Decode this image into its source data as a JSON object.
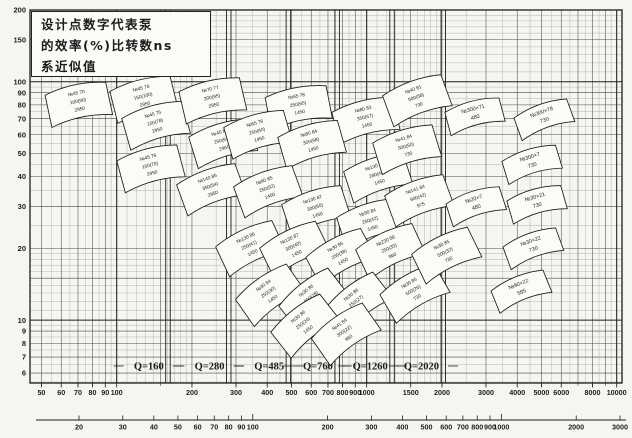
{
  "page": {
    "background": "#f6f5f1",
    "ink": "#1c1c1c",
    "paper": "#fcfbf7"
  },
  "legend": {
    "lines": [
      "设计点数字代表泵",
      "的效率(%)比转数ns",
      "系近似值"
    ]
  },
  "chart_data": {
    "type": "area",
    "subtype": "pump-type-spectrum-log-log-QH-field-chart",
    "title": "",
    "xlabel": "",
    "ylabel": "",
    "x_axis": {
      "scale": "log",
      "min": 45,
      "max": 10500,
      "tick_labels": [
        50,
        60,
        70,
        80,
        90,
        100,
        200,
        300,
        400,
        500,
        600,
        700,
        800,
        900,
        1000,
        1500,
        2000,
        3000,
        4000,
        5000,
        6000,
        8000,
        10000
      ]
    },
    "y_axis": {
      "scale": "log",
      "min": 5.45,
      "max": 200,
      "tick_labels": [
        200,
        150,
        100,
        90,
        80,
        70,
        60,
        50,
        40,
        30,
        20,
        10,
        9,
        8,
        7,
        6
      ]
    },
    "q_dividers": {
      "prefix": "Q=",
      "values": [
        160,
        280,
        485,
        760,
        1260,
        2020
      ],
      "labels": [
        "Q=160",
        "Q=280",
        "Q=485",
        "Q=760",
        "Q=1260",
        "Q=2020"
      ]
    },
    "second_axis": {
      "scale": "log",
      "min": 14,
      "max": 3200,
      "tick_labels": [
        20,
        30,
        40,
        50,
        60,
        70,
        80,
        90,
        100,
        200,
        300,
        400,
        500,
        600,
        700,
        800,
        900,
        1000,
        2000,
        3000
      ]
    },
    "marker": {
      "type": "circle",
      "at_q": 760,
      "y_px": 348
    },
    "pump_boxes": [
      {
        "cx": 78,
        "cy": 101,
        "rot": -12,
        "lines": [
          "№45 70",
          "100(90)",
          "2950"
        ]
      },
      {
        "cx": 143,
        "cy": 96,
        "rot": -14,
        "lines": [
          "№45 76",
          "150(100)",
          "2950"
        ]
      },
      {
        "cx": 155,
        "cy": 122,
        "rot": -16,
        "lines": [
          "№45 75",
          "150(78)",
          "2950"
        ]
      },
      {
        "cx": 212,
        "cy": 97,
        "rot": -13,
        "lines": [
          "№70 77",
          "200(95)",
          "2950"
        ]
      },
      {
        "cx": 150,
        "cy": 165,
        "rot": -15,
        "lines": [
          "№45 76",
          "150(70)",
          "2950"
        ]
      },
      {
        "cx": 210,
        "cy": 186,
        "rot": -20,
        "lines": [
          "№140 85",
          "350(54)",
          "2950"
        ]
      },
      {
        "cx": 222,
        "cy": 140,
        "rot": -17,
        "lines": [
          "№45 81",
          "250(64)",
          "2950"
        ]
      },
      {
        "cx": 298,
        "cy": 104,
        "rot": -11,
        "lines": [
          "№65 78",
          "250(65)",
          "1450"
        ]
      },
      {
        "cx": 365,
        "cy": 117,
        "rot": -14,
        "lines": [
          "№80 83",
          "350(57)",
          "1450"
        ]
      },
      {
        "cx": 257,
        "cy": 131,
        "rot": -16,
        "lines": [
          "№65 76",
          "250(60)",
          "1450"
        ]
      },
      {
        "cx": 311,
        "cy": 141,
        "rot": -16,
        "lines": [
          "№80 84",
          "300(58)",
          "1450"
        ]
      },
      {
        "cx": 267,
        "cy": 188,
        "rot": -20,
        "lines": [
          "№90 85",
          "250(52)",
          "1450"
        ]
      },
      {
        "cx": 315,
        "cy": 207,
        "rot": -18,
        "lines": [
          "№130 87",
          "300(50)",
          "1450"
        ]
      },
      {
        "cx": 370,
        "cy": 220,
        "rot": -18,
        "lines": [
          "№90 84",
          "250(42)",
          "1450"
        ]
      },
      {
        "cx": 377,
        "cy": 174,
        "rot": -18,
        "lines": [
          "№130 83",
          "280(48)",
          "1450"
        ]
      },
      {
        "cx": 249,
        "cy": 245,
        "rot": -25,
        "lines": [
          "№130 86",
          "250(41)",
          "1450"
        ]
      },
      {
        "cx": 293,
        "cy": 246,
        "rot": -26,
        "lines": [
          "№130 87",
          "300(40)",
          "1450"
        ]
      },
      {
        "cx": 339,
        "cy": 254,
        "rot": -28,
        "lines": [
          "№30 85",
          "250(38)",
          "1450"
        ]
      },
      {
        "cx": 389,
        "cy": 248,
        "rot": -25,
        "lines": [
          "№230 86",
          "250(35)",
          "960"
        ]
      },
      {
        "cx": 268,
        "cy": 292,
        "rot": -35,
        "lines": [
          "№30 84",
          "250(30)",
          "1450"
        ]
      },
      {
        "cx": 311,
        "cy": 297,
        "rot": -38,
        "lines": [
          "№30 86",
          "300(28)",
          "1450"
        ]
      },
      {
        "cx": 356,
        "cy": 301,
        "rot": -38,
        "lines": [
          "№30 86",
          "250(27)",
          "960"
        ]
      },
      {
        "cx": 303,
        "cy": 323,
        "rot": -38,
        "lines": [
          "№30 86",
          "250(24)",
          "1450"
        ]
      },
      {
        "cx": 344,
        "cy": 331,
        "rot": -35,
        "lines": [
          "№41 84",
          "300(22)",
          "960"
        ]
      },
      {
        "cx": 413,
        "cy": 290,
        "rot": -30,
        "lines": [
          "№30 85",
          "500(26)",
          "730"
        ]
      },
      {
        "cx": 445,
        "cy": 252,
        "rot": -26,
        "lines": [
          "№30 85",
          "500(32)",
          "730"
        ]
      },
      {
        "cx": 416,
        "cy": 97,
        "rot": -20,
        "lines": [
          "№40 81",
          "500(58)",
          "730"
        ]
      },
      {
        "cx": 406,
        "cy": 146,
        "rot": -17,
        "lines": [
          "№41 84",
          "500(50)",
          "730"
        ]
      },
      {
        "cx": 418,
        "cy": 197,
        "rot": -20,
        "lines": [
          "№141 84",
          "500(42)",
          "975"
        ]
      },
      {
        "cx": 474,
        "cy": 113,
        "rot": -15,
        "lines": [
          "№300×71",
          "480"
        ]
      },
      {
        "cx": 543,
        "cy": 116,
        "rot": -20,
        "lines": [
          "№300×78",
          "730"
        ]
      },
      {
        "cx": 531,
        "cy": 161,
        "rot": -17,
        "lines": [
          "№300×7",
          "730"
        ]
      },
      {
        "cx": 475,
        "cy": 203,
        "rot": -18,
        "lines": [
          "№20×7",
          "480"
        ]
      },
      {
        "cx": 536,
        "cy": 201,
        "rot": -16,
        "lines": [
          "№30×21",
          "730"
        ]
      },
      {
        "cx": 532,
        "cy": 245,
        "rot": -20,
        "lines": [
          "№30×22",
          "730"
        ]
      },
      {
        "cx": 520,
        "cy": 288,
        "rot": -22,
        "lines": [
          "№90×22",
          "585"
        ]
      }
    ]
  }
}
